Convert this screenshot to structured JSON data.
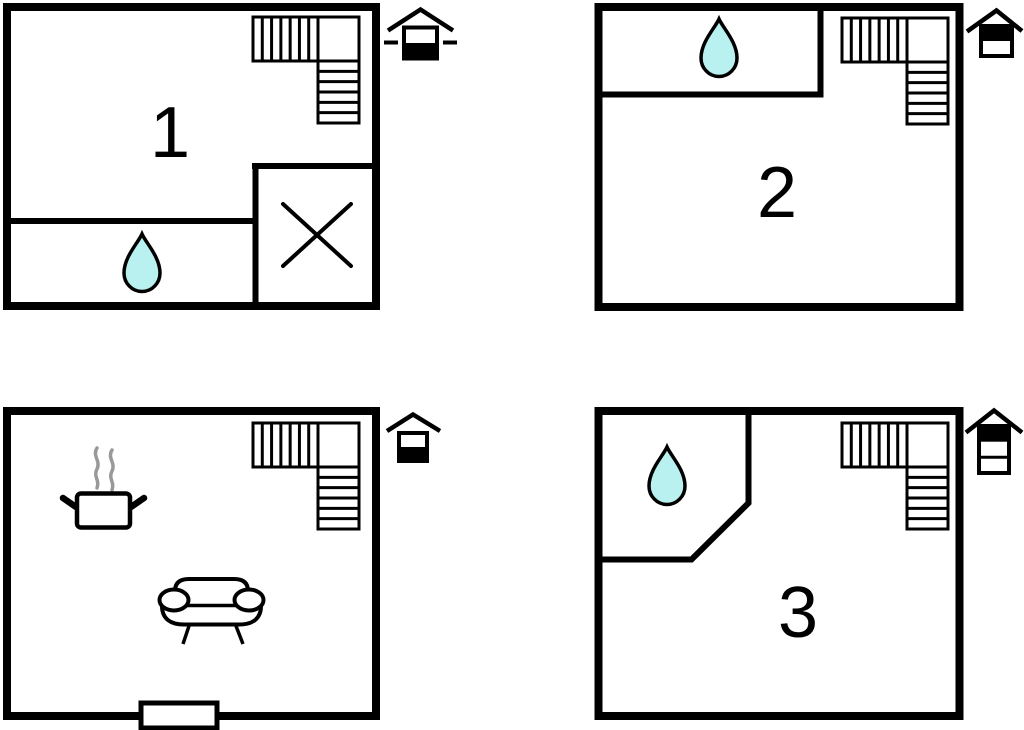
{
  "diagram": {
    "type": "apartment-floor-plans",
    "floors": [
      {
        "name": "basement",
        "room_label": "1",
        "position": "top-left",
        "level_icon": "house-cross-section-lower-level-highlighted-with-ground-line-dashes",
        "features": [
          "l-shaped-staircase",
          "water-drop",
          "shower-cross"
        ]
      },
      {
        "name": "first-floor",
        "room_label": "2",
        "position": "top-right",
        "level_icon": "house-cross-section-upper-of-2-levels-highlighted",
        "features": [
          "water-drop",
          "l-shaped-staircase"
        ]
      },
      {
        "name": "ground-floor",
        "room_label": "",
        "position": "bottom-left",
        "level_icon": "house-cross-section-lower-of-2-levels-highlighted",
        "features": [
          "cooking-pot-with-steam",
          "sofa",
          "l-shaped-staircase",
          "entrance-door"
        ]
      },
      {
        "name": "second-floor",
        "room_label": "3",
        "position": "bottom-right",
        "level_icon": "house-cross-section-top-of-3-levels-highlighted",
        "features": [
          "water-drop",
          "l-shaped-staircase"
        ]
      }
    ]
  },
  "colors": {
    "wall": "#000000",
    "background": "#ffffff",
    "water_drop_fill": "#b8f1ef",
    "water_drop_outline": "#000000",
    "steam": "#999999"
  }
}
